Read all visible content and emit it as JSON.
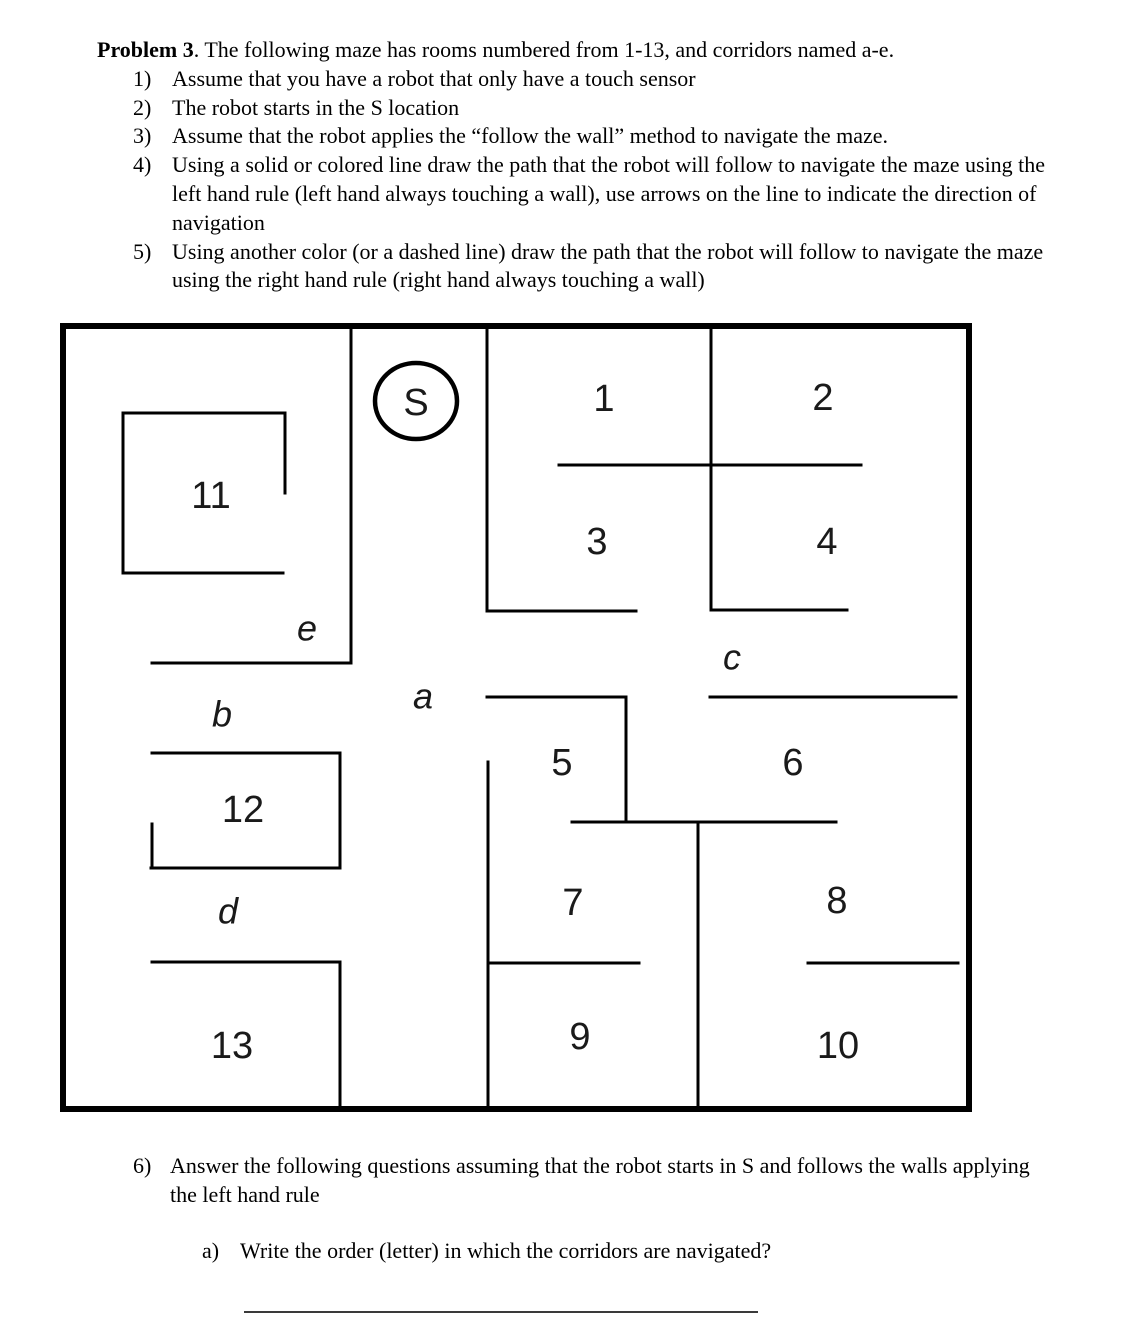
{
  "problem": {
    "title_bold": "Problem 3",
    "title_rest": ". The following maze has rooms numbered from 1-13, and corridors named a-e.",
    "items": [
      {
        "num": "1)",
        "text": "Assume that you have a robot that only have a touch sensor"
      },
      {
        "num": "2)",
        "text": "The robot starts in the S location"
      },
      {
        "num": "3)",
        "text": "Assume that the robot applies the “follow the wall” method to navigate the maze."
      },
      {
        "num": "4)",
        "text": "Using a solid or colored line draw the path that the robot will follow to navigate the maze using the left hand rule (left hand always touching a wall), use arrows on the line to indicate the direction of navigation"
      },
      {
        "num": "5)",
        "text": "Using another color (or a dashed line) draw the path that the robot will follow to navigate the maze using the right hand rule (right hand always touching a wall)"
      }
    ]
  },
  "maze": {
    "ink_color": "#000000",
    "border": {
      "x": 63,
      "y": 326,
      "w": 906,
      "h": 783,
      "stroke_width": 6
    },
    "wall_stroke_width": 3,
    "start_label": "S",
    "start_circle": {
      "cx": 416,
      "cy": 401,
      "rx": 41,
      "ry": 38,
      "stroke_width": 4.5
    },
    "walls": [
      {
        "x1": 351,
        "y1": 326,
        "x2": 351,
        "y2": 663
      },
      {
        "x1": 152,
        "y1": 663,
        "x2": 351,
        "y2": 663
      },
      {
        "x1": 123,
        "y1": 413,
        "x2": 285,
        "y2": 413
      },
      {
        "x1": 123,
        "y1": 413,
        "x2": 123,
        "y2": 573
      },
      {
        "x1": 285,
        "y1": 413,
        "x2": 285,
        "y2": 493
      },
      {
        "x1": 123,
        "y1": 573,
        "x2": 283,
        "y2": 573
      },
      {
        "x1": 487,
        "y1": 326,
        "x2": 487,
        "y2": 611
      },
      {
        "x1": 487,
        "y1": 611,
        "x2": 636,
        "y2": 611
      },
      {
        "x1": 711,
        "y1": 326,
        "x2": 711,
        "y2": 610
      },
      {
        "x1": 559,
        "y1": 465,
        "x2": 861,
        "y2": 465
      },
      {
        "x1": 711,
        "y1": 610,
        "x2": 847,
        "y2": 610
      },
      {
        "x1": 710,
        "y1": 697,
        "x2": 956,
        "y2": 697
      },
      {
        "x1": 487,
        "y1": 697,
        "x2": 626,
        "y2": 697
      },
      {
        "x1": 626,
        "y1": 697,
        "x2": 626,
        "y2": 822
      },
      {
        "x1": 572,
        "y1": 822,
        "x2": 836,
        "y2": 822
      },
      {
        "x1": 698,
        "y1": 822,
        "x2": 698,
        "y2": 1109
      },
      {
        "x1": 488,
        "y1": 762,
        "x2": 488,
        "y2": 1109
      },
      {
        "x1": 488,
        "y1": 963,
        "x2": 639,
        "y2": 963
      },
      {
        "x1": 808,
        "y1": 963,
        "x2": 958,
        "y2": 963
      },
      {
        "x1": 152,
        "y1": 753,
        "x2": 340,
        "y2": 753
      },
      {
        "x1": 340,
        "y1": 753,
        "x2": 340,
        "y2": 868
      },
      {
        "x1": 151,
        "y1": 868,
        "x2": 340,
        "y2": 868
      },
      {
        "x1": 152,
        "y1": 824,
        "x2": 152,
        "y2": 868
      },
      {
        "x1": 152,
        "y1": 962,
        "x2": 340,
        "y2": 962
      },
      {
        "x1": 340,
        "y1": 962,
        "x2": 340,
        "y2": 1109
      }
    ],
    "rooms": [
      {
        "label": "1",
        "x": 604,
        "y": 399
      },
      {
        "label": "2",
        "x": 823,
        "y": 398
      },
      {
        "label": "3",
        "x": 597,
        "y": 542
      },
      {
        "label": "4",
        "x": 827,
        "y": 542
      },
      {
        "label": "5",
        "x": 562,
        "y": 763
      },
      {
        "label": "6",
        "x": 793,
        "y": 763
      },
      {
        "label": "7",
        "x": 573,
        "y": 903
      },
      {
        "label": "8",
        "x": 837,
        "y": 901
      },
      {
        "label": "9",
        "x": 580,
        "y": 1037
      },
      {
        "label": "10",
        "x": 838,
        "y": 1046
      },
      {
        "label": "11",
        "x": 211,
        "y": 496
      },
      {
        "label": "12",
        "x": 243,
        "y": 810
      },
      {
        "label": "13",
        "x": 232,
        "y": 1046
      }
    ],
    "corridors": [
      {
        "label": "a",
        "x": 423,
        "y": 696
      },
      {
        "label": "b",
        "x": 222,
        "y": 714
      },
      {
        "label": "c",
        "x": 732,
        "y": 657
      },
      {
        "label": "d",
        "x": 228,
        "y": 911
      },
      {
        "label": "e",
        "x": 307,
        "y": 628
      }
    ]
  },
  "question6": {
    "num": "6)",
    "text": "Answer the following questions assuming that the robot starts in S and follows the walls applying the left hand rule",
    "sub_num": "a)",
    "sub_text": "Write the order (letter) in which the corridors are navigated?"
  }
}
